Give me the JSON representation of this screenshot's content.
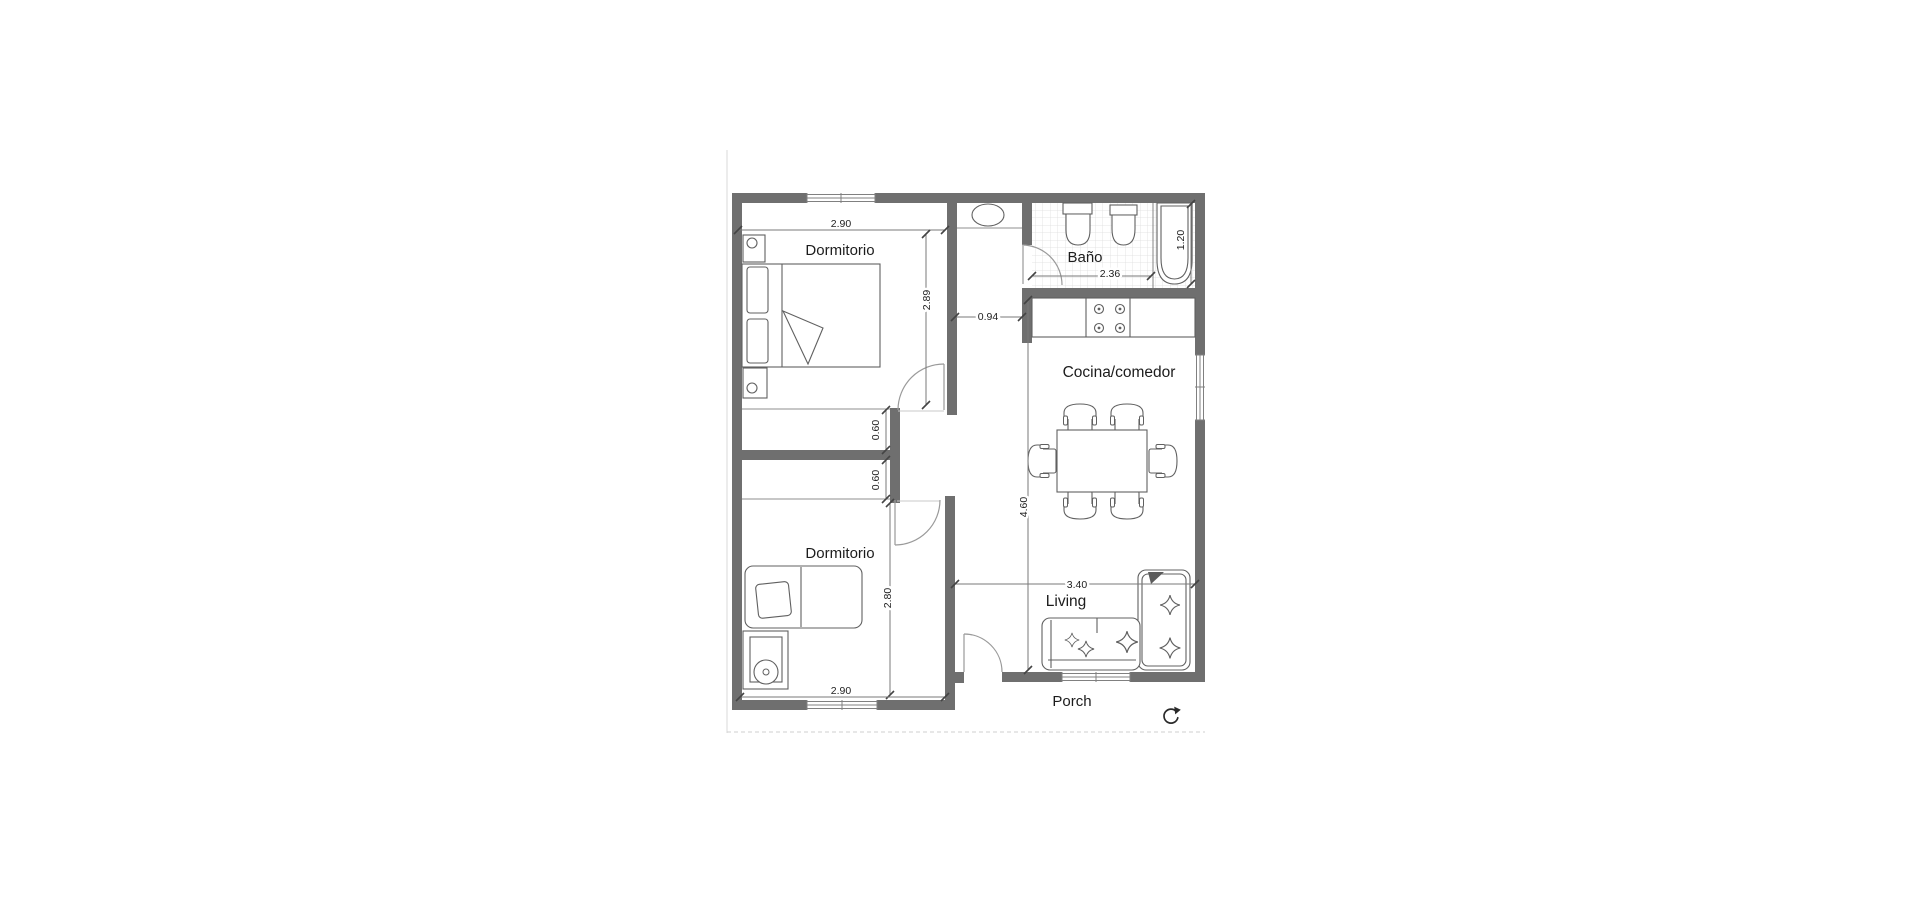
{
  "canvas": {
    "width": 1920,
    "height": 920,
    "background": "#ffffff"
  },
  "plan": {
    "labels": {
      "bedroom1": "Dormitorio",
      "bedroom2": "Dormitorio",
      "bathroom": "Baño",
      "kitchen": "Cocina/comedor",
      "living": "Living",
      "porch": "Porch"
    },
    "dimensions": {
      "bedroom1_width": "2.90",
      "bedroom1_height": "2.89",
      "hall_width": "0.94",
      "closet1_depth": "0.60",
      "closet2_depth": "0.60",
      "bedroom2_height": "2.80",
      "bedroom2_width": "2.90",
      "bathroom_width": "2.36",
      "bathtub_length": "1.20",
      "kitchen_length": "4.60",
      "living_width": "3.40"
    },
    "colors": {
      "wall": "#6f6f6f",
      "thin_line": "#8f8f8f",
      "furniture": "#606060",
      "text": "#1c1c1c",
      "tile": "#dcdcdc"
    },
    "icons": {
      "rotate": "rotate-clockwise"
    }
  }
}
